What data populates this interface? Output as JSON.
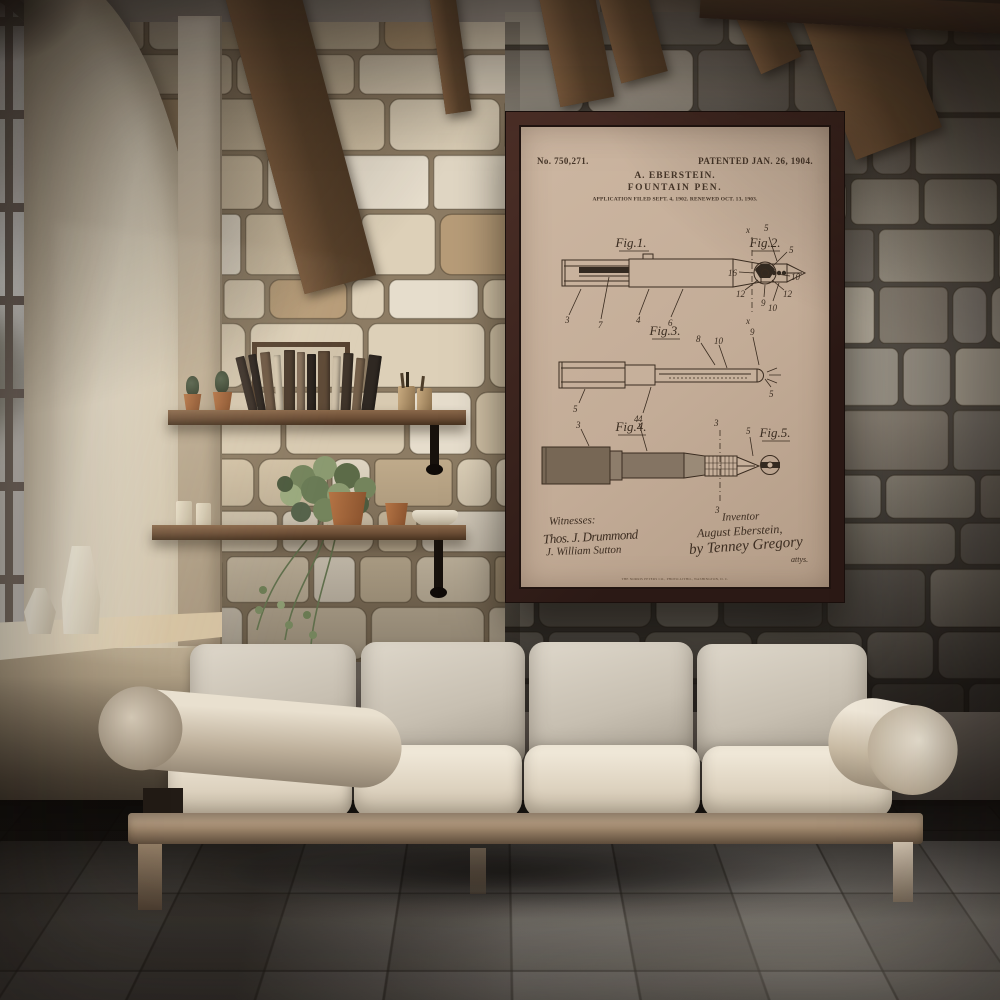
{
  "poster": {
    "patent_number": "No. 750,271.",
    "patented": "PATENTED JAN. 26, 1904.",
    "inventor_line": "A. EBERSTEIN.",
    "title": "FOUNTAIN PEN.",
    "application_line": "APPLICATION FILED SEPT. 4, 1902. RENEWED OCT. 13, 1903.",
    "figures": {
      "fig1": {
        "label": "Fig.1.",
        "callouts": [
          "3",
          "7",
          "4",
          "6",
          "x",
          "x",
          "5",
          "10"
        ]
      },
      "fig2": {
        "label": "Fig.2.",
        "callouts": [
          "16",
          "12",
          "9",
          "12",
          "10",
          "5"
        ]
      },
      "fig3": {
        "label": "Fig.3.",
        "callouts": [
          "8",
          "10",
          "9",
          "5",
          "5",
          "4"
        ]
      },
      "fig4": {
        "label": "Fig.4.",
        "callouts": [
          "3",
          "4",
          "3",
          "5",
          "3"
        ]
      },
      "fig5": {
        "label": "Fig.5."
      }
    },
    "witnesses_label": "Witnesses:",
    "witness_signatures": [
      "Thos. J. Drummond",
      "J. William Sutton"
    ],
    "inventor_label": "Inventor",
    "inventor_signature": "August Eberstein,",
    "attorney_signature": "by Tenney Gregory",
    "attorney_suffix": "attys.",
    "printer_line": "THE NORRIS PETERS CO., PHOTO-LITHO., WASHINGTON, D. C."
  },
  "palette": {
    "poster_paper": "#c3ac97",
    "poster_frame": "#36211c",
    "ink": "#453528",
    "wall_left_mortar": "#8d7c64",
    "wall_right_mortar": "#5a544c",
    "sofa_leather": "#e3dccd",
    "shelf_wood": "#6b4d35",
    "terracotta": "#a8693f",
    "floor_tile": "#8f8a81"
  }
}
